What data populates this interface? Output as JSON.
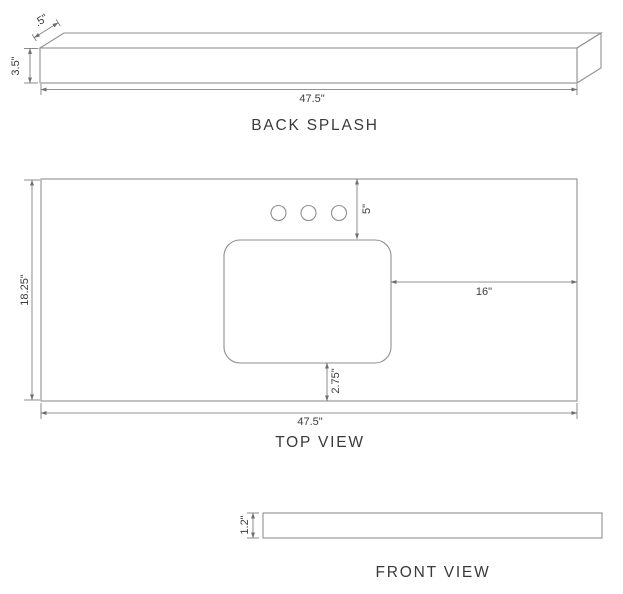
{
  "drawing": {
    "back_splash": {
      "title": "BACK SPLASH",
      "depth_dim": ".5\"",
      "height_dim": "3.5\"",
      "width_dim": "47.5\""
    },
    "top_view": {
      "title": "TOP VIEW",
      "depth_dim": "18.25\"",
      "backsplash_to_sink_dim": "5\"",
      "sink_to_right_edge_dim": "16\"",
      "sink_to_front_edge_dim": "2.75\"",
      "width_dim": "47.5\"",
      "faucet_hole_count": 3
    },
    "front_view": {
      "title": "FRONT VIEW",
      "thickness_dim": "1.2\""
    }
  },
  "colors": {
    "background": "#ffffff",
    "shape_outline": "#8f8f8f",
    "dimension_line": "#6f6f6f",
    "text": "#3c3c3c"
  }
}
